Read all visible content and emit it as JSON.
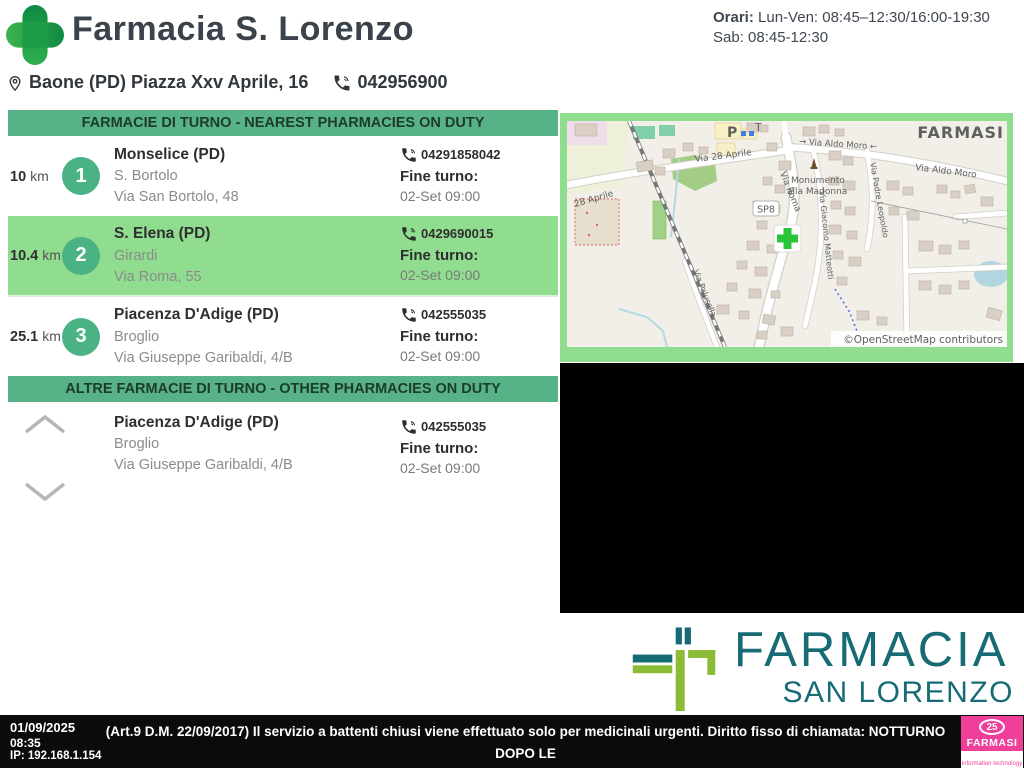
{
  "header": {
    "title": "Farmacia S. Lorenzo",
    "hours_label": "Orari:",
    "hours_text": " Lun-Ven: 08:45–12:30/16:00-19:30 Sab: 08:45-12:30",
    "address": "Baone (PD) Piazza Xxv Aprile, 16",
    "phone": "042956900"
  },
  "nearest": {
    "banner": "FARMACIE DI TURNO - NEAREST PHARMACIES ON DUTY",
    "items": [
      {
        "distance": "10",
        "unit": "km",
        "rank": "1",
        "city": "Monselice (PD)",
        "name": "S. Bortolo",
        "street": "Via San Bortolo, 48",
        "phone": "04291858042",
        "fine_turno_label": "Fine turno:",
        "fine_turno": "02-Set 09:00"
      },
      {
        "distance": "10.4",
        "unit": "km",
        "rank": "2",
        "city": "S. Elena (PD)",
        "name": "Girardi",
        "street": "Via Roma, 55",
        "phone": "0429690015",
        "fine_turno_label": "Fine turno:",
        "fine_turno": "02-Set 09:00"
      },
      {
        "distance": "25.1",
        "unit": "km",
        "rank": "3",
        "city": "Piacenza D'Adige (PD)",
        "name": "Broglio",
        "street": "Via Giuseppe Garibaldi, 4/B",
        "phone": "042555035",
        "fine_turno_label": "Fine turno:",
        "fine_turno": "02-Set 09:00"
      }
    ]
  },
  "other": {
    "banner": "ALTRE FARMACIE DI TURNO - OTHER PHARMACIES ON DUTY",
    "items": [
      {
        "city": "Piacenza D'Adige (PD)",
        "name": "Broglio",
        "street": "Via Giuseppe Garibaldi, 4/B",
        "phone": "042555035",
        "fine_turno_label": "Fine turno:",
        "fine_turno": "02-Set 09:00"
      }
    ]
  },
  "map": {
    "watermark": "FARMASI",
    "attribution": "©OpenStreetMap contributors",
    "labels": {
      "via_28_aprile": "Via 28 Aprile",
      "aprile_28": "28 Aprile",
      "via_aldo_moro_1": "→ Via Aldo Moro ←",
      "via_aldo_moro_2": "Via Aldo Moro",
      "monument_1": "Monumento",
      "monument_2": "alla Madonna",
      "sp8": "SP8",
      "via_roma": "Via Roma",
      "via_padre_leopoldo": "Via Padre Leopoldo",
      "via_giacomo_matteotti": "Via Giacomo Matteotti",
      "via_palusella": "Via Palusella",
      "parking": "P",
      "telecom": "T"
    }
  },
  "brand": {
    "line1": "FARMACIA",
    "line2": "SAN LORENZO"
  },
  "footer": {
    "date": "01/09/2025",
    "time": "08:35",
    "ip": "IP: 192.168.1.154",
    "notice_line1": "(Art.9 D.M. 22/09/2017) Il servizio a battenti chiusi viene effettuato solo per medicinali urgenti. Diritto fisso di chiamata: NOTTURNO DOPO LE",
    "notice_line2": "22 A BATTENTI CHIUSI: €10,00 (Art.9 D.M. 22/09/2017)",
    "farmasi_badge": "25",
    "farmasi_name": "FARMASI",
    "farmasi_sub": "information technology"
  },
  "colors": {
    "banner_green": "#57b287",
    "highlight_green": "#90dd90",
    "circle_green": "#4bb286",
    "brand_teal": "#166b75",
    "brand_lime": "#8cbb35",
    "farmasi_pink": "#ef3f9a",
    "logo_green_dark": "#128a45",
    "logo_green_light": "#3cb54f"
  }
}
